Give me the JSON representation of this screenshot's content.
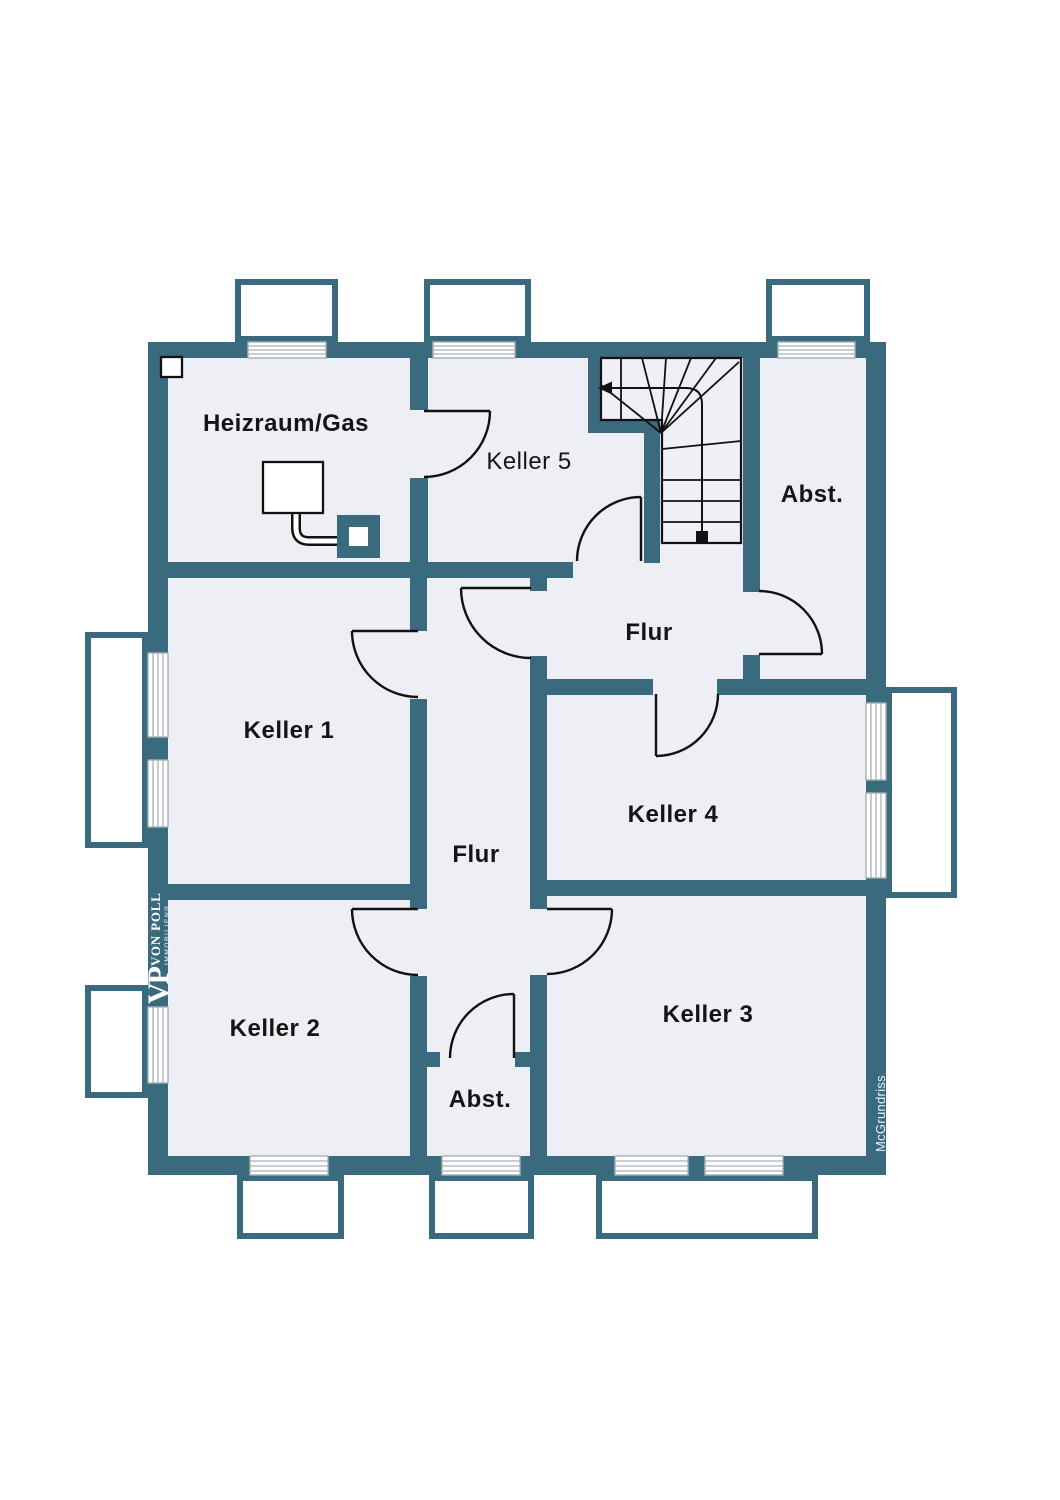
{
  "plan": {
    "type": "basement-floor-plan",
    "colors": {
      "wall": "#3a6a7e",
      "floor": "#edeff4",
      "background": "#ffffff",
      "line": "#111111",
      "glazing_line": "#a8b0b6"
    },
    "rooms": [
      {
        "name": "heizraum-gas",
        "label": "Heizraum/Gas"
      },
      {
        "name": "keller-5",
        "label": "Keller 5"
      },
      {
        "name": "abstellraum-oben",
        "label": "Abst."
      },
      {
        "name": "flur-oben",
        "label": "Flur"
      },
      {
        "name": "keller-1",
        "label": "Keller 1"
      },
      {
        "name": "keller-4",
        "label": "Keller 4"
      },
      {
        "name": "flur-mitte",
        "label": "Flur"
      },
      {
        "name": "keller-2",
        "label": "Keller 2"
      },
      {
        "name": "abstellraum-unten",
        "label": "Abst."
      },
      {
        "name": "keller-3",
        "label": "Keller 3"
      }
    ],
    "branding": {
      "monogram": "VP",
      "name": "VON POLL",
      "subtitle": "IMMOBILIEN®",
      "credit": "McGrundriss"
    }
  }
}
